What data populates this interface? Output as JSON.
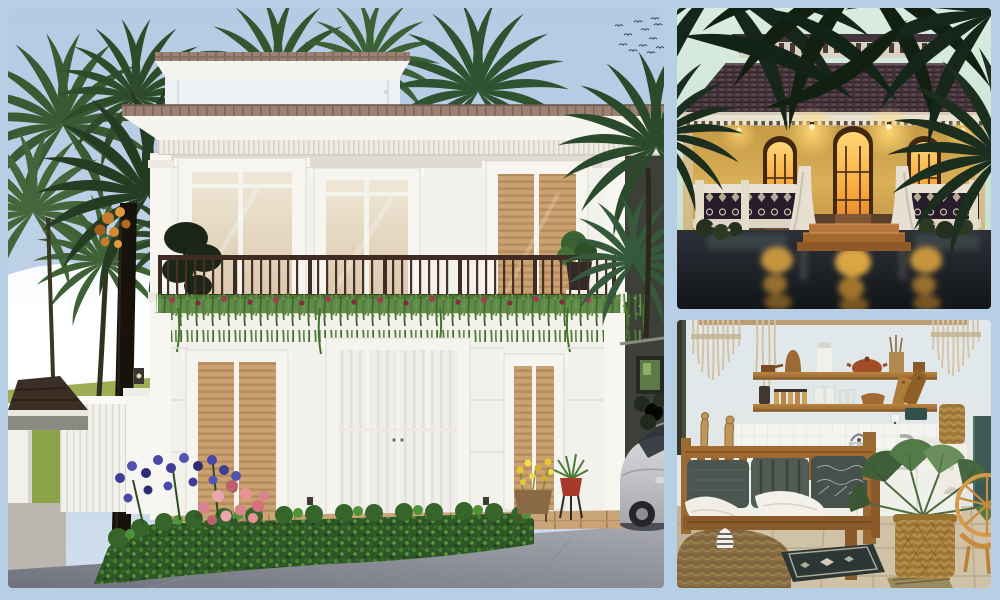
{
  "page": {
    "kind": "photo-collage",
    "frame_color": "#b7cfe5"
  },
  "collage": {
    "panels": [
      {
        "id": "villa-exterior",
        "position": "left",
        "alt": "3D rendering of a white two-storey tropical villa with tiled roof edge, balcony with dark railing and trailing planters, tall palm trees, flowering hedge with blue and pink blooms, white fence and a silver car parked at the right"
      },
      {
        "id": "heritage-house-dusk",
        "position": "top-right",
        "alt": "Heritage colonial house at dusk with dark tiled roof, amber walls, three glowing arched doors, white balustrade with ornate panels, central steps and golden light reflections on wet ground beneath palm fronds"
      },
      {
        "id": "boho-interior",
        "position": "bottom-right",
        "alt": "Rustic boho kitchen lounge with macrame wall hangings, two wooden shelves of pottery and jars, white tiled kitchen counter with kettle and stove, wooden bench with grey cushions and white throws, jute pouf, patterned rug and a palm plant in a woven basket"
      }
    ]
  },
  "colors": {
    "frame-bg": "#b7cfe5",
    "sky-blue": "#b9cfe6",
    "villa-white": "#f2f1ec",
    "roof-tile": "#9c8175",
    "railing-brown": "#3f2a24",
    "foliage-green": "#3a5d33",
    "hedge-green": "#2e5626",
    "flower-blue": "#44479e",
    "flower-pink": "#d9848e",
    "pavement-gray": "#8d8f98",
    "dusk-sky": "#cfe7da",
    "dusk-roof": "#443340",
    "amber-wall": "#cda24b",
    "window-glow": "#f6a83c",
    "water-dark": "#1a1f24",
    "interior-wall": "#dfe7ea",
    "shelf-wood": "#b5813f",
    "bench-wood": "#8a5a2a",
    "cushion-gray": "#4b5650",
    "jute-tan": "#a8813f",
    "plant-green": "#547a48",
    "tile-floor": "#cfc2a6"
  }
}
